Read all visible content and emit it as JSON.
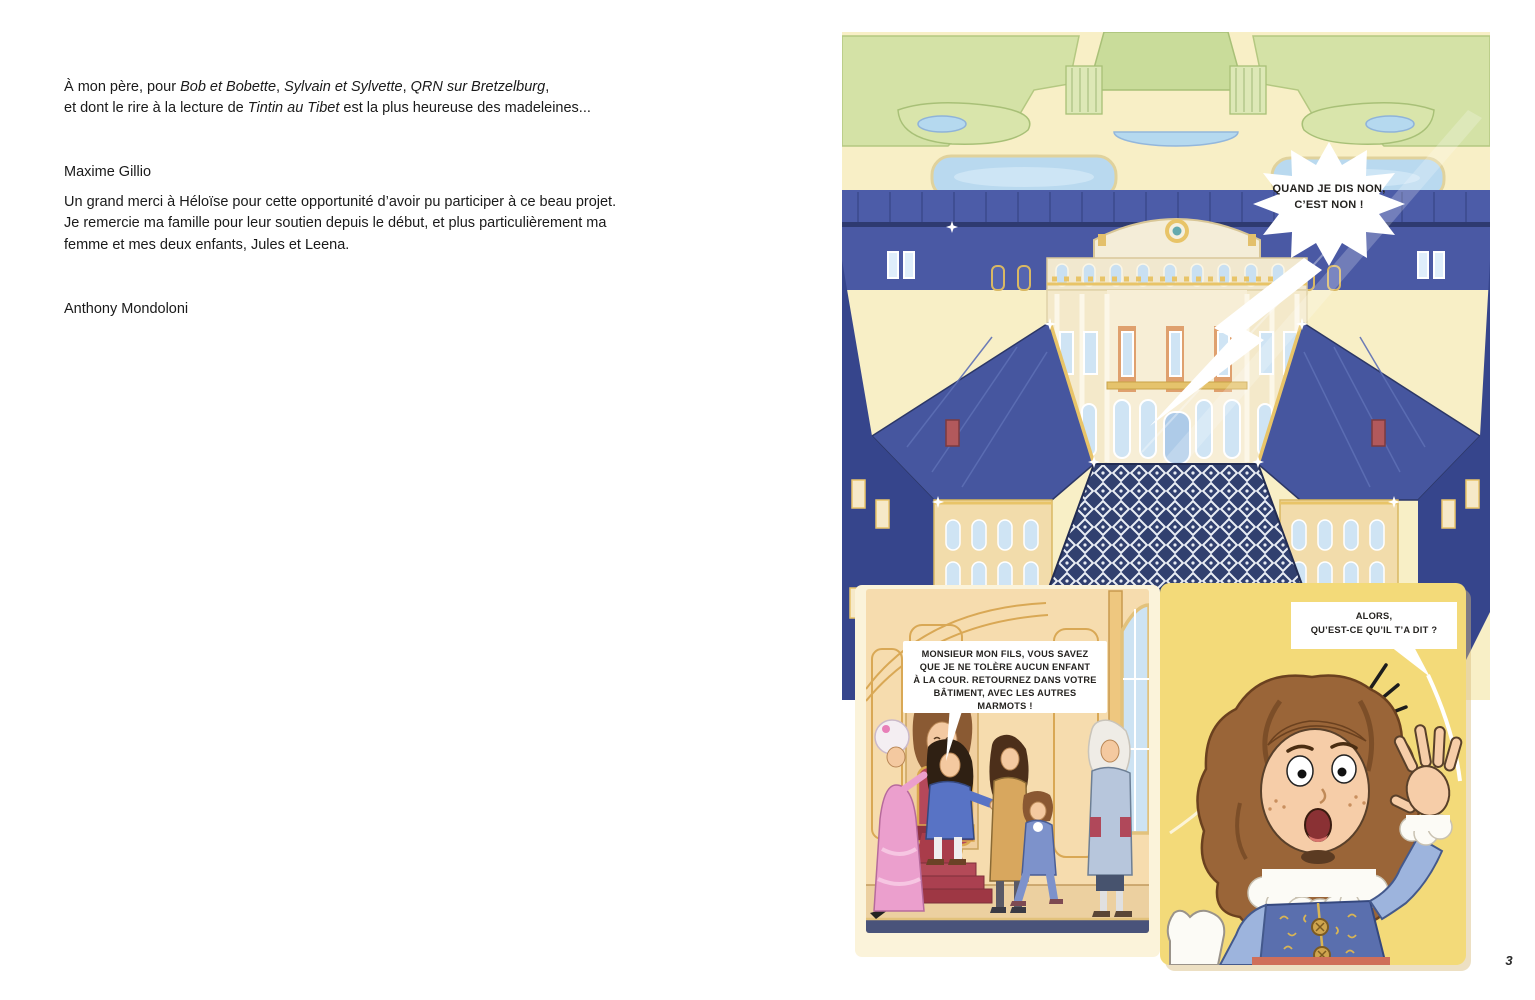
{
  "left_page": {
    "dedication": {
      "l1s1": "À mon père, pour ",
      "l1i1": "Bob et Bobette",
      "l1s2": ", ",
      "l1i2": "Sylvain et Sylvette",
      "l1s3": ", ",
      "l1i3": "QRN sur Bretzelburg",
      "l1s4": ",",
      "l2s1": "et dont le rire à la lecture de ",
      "l2i1": "Tintin au Tibet",
      "l2s2": " est la plus heureuse des madeleines...",
      "author": "Maxime Gillio"
    },
    "acknowledgment": {
      "text": "Un grand merci à Héloïse pour cette opportunité d’avoir pu participer à ce beau projet.\nJe remercie ma famille pour leur soutien depuis le début, et plus particulièrement ma\nfemme et mes deux enfants, Jules et Leena.",
      "author": "Anthony Mondoloni"
    }
  },
  "comic_page": {
    "bubbles": {
      "shout": "QUAND JE DIS NON,\nC’EST NON !",
      "king": "MONSIEUR MON FILS, VOUS SAVEZ\nQUE JE NE TOLÈRE AUCUN ENFANT\nÀ LA COUR. RETOURNEZ DANS VOTRE\nBÂTIMENT, AVEC LES AUTRES\nMARMOTS !",
      "question": "ALORS,\nQU’EST-CE QU’IL T’A DIT ?"
    },
    "page_number": "3"
  },
  "colors": {
    "panel_yellow": "#f3da79",
    "roof_blue": "#46569f",
    "wall_blue_dark": "#36458c",
    "facade_cream": "#f4e9ca",
    "garden_green": "#d4e2a6",
    "pond_blue": "#b5d9ef",
    "gold_trim": "#e8c468",
    "carpet_red": "#a93c4a",
    "throne_room_peach": "#f6dcae",
    "courtyard_navy": "#31406f",
    "text_black": "#1a1a1a"
  }
}
